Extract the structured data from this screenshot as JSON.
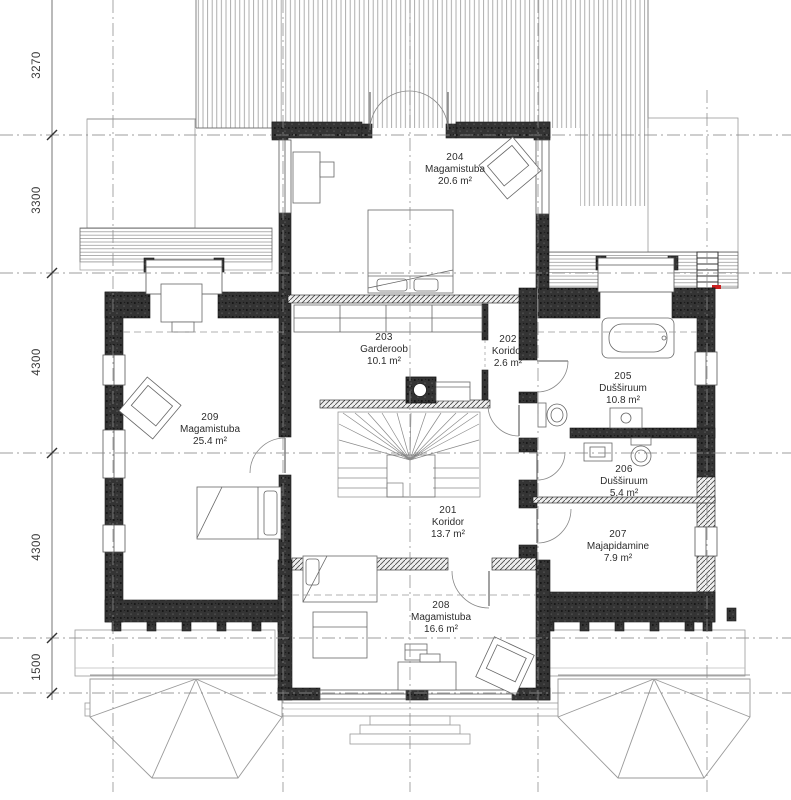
{
  "floor_plan": {
    "rooms": [
      {
        "number": "201",
        "name": "Koridor",
        "area": "13.7 m²"
      },
      {
        "number": "202",
        "name": "Koridor",
        "area": "2.6 m²"
      },
      {
        "number": "203",
        "name": "Garderoob",
        "area": "10.1 m²"
      },
      {
        "number": "204",
        "name": "Magamistuba",
        "area": "20.6 m²"
      },
      {
        "number": "205",
        "name": "Dušširuum",
        "area": "10.8 m²"
      },
      {
        "number": "206",
        "name": "Dušširuum",
        "area": "5.4 m²"
      },
      {
        "number": "207",
        "name": "Majapidamine",
        "area": "7.9 m²"
      },
      {
        "number": "208",
        "name": "Magamistuba",
        "area": "16.6 m²"
      },
      {
        "number": "209",
        "name": "Magamistuba",
        "area": "25.4 m²"
      }
    ],
    "dimensions_left": [
      {
        "value": "3270"
      },
      {
        "value": "3300"
      },
      {
        "value": "4300"
      },
      {
        "value": "4300"
      },
      {
        "value": "1500"
      }
    ],
    "colors": {
      "wall_dark": "#2f2f2f",
      "grid_line": "#8c8c8c",
      "thin_line": "#777777",
      "accent_red": "#cc2222",
      "text": "#2d2d2d"
    }
  }
}
